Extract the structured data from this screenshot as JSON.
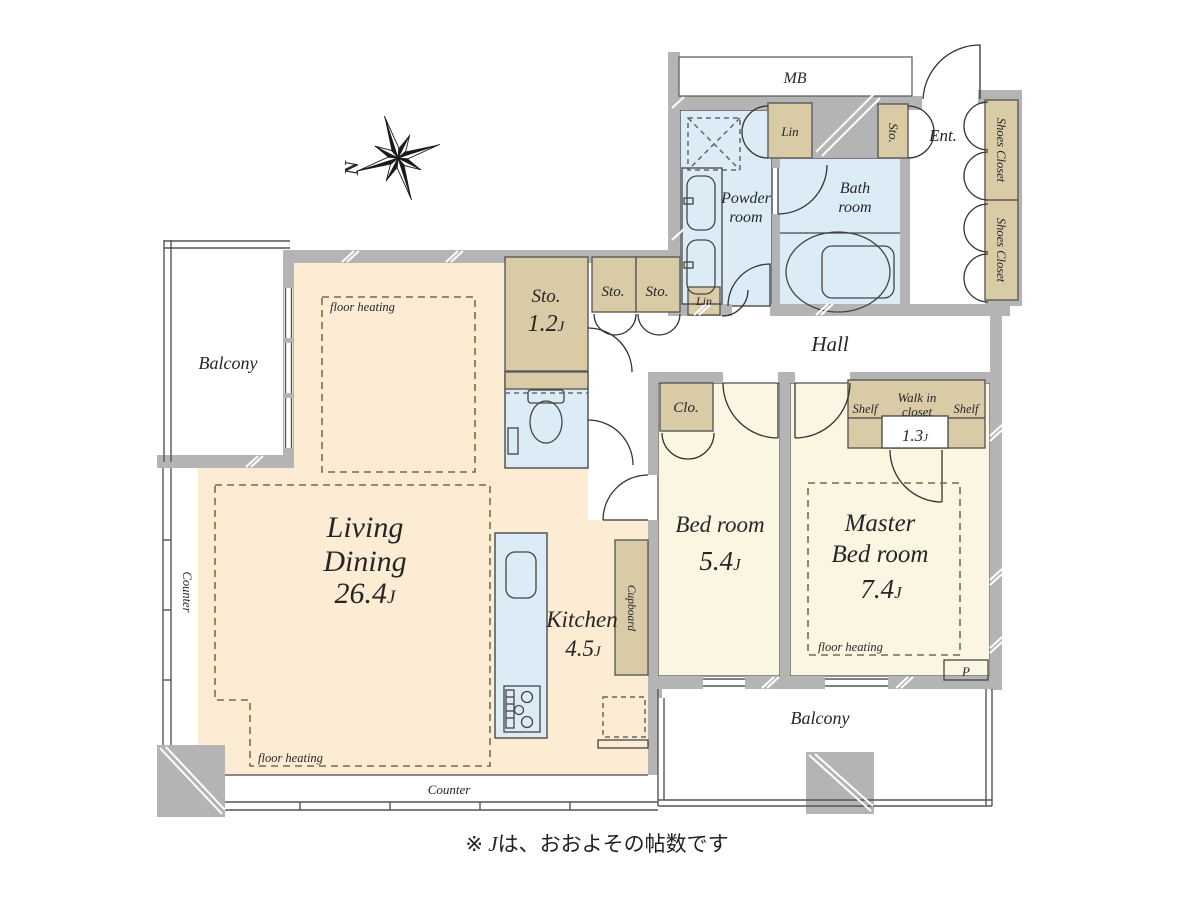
{
  "colors": {
    "living_floor": "#fcecd3",
    "bedroom_floor": "#faf6e2",
    "wet_area_floor": "#dcecf7",
    "closet_fill": "#d8cba6",
    "wall_gray": "#b4b4b4",
    "line": "#444444"
  },
  "compass": {
    "north": "N"
  },
  "labels": {
    "mb": "MB",
    "powder_room_line1": "Powder",
    "powder_room_line2": "room",
    "bath_room_line1": "Bath",
    "bath_room_line2": "room",
    "lin_upper": "Lin",
    "lin_lower": "Lin",
    "sto_entrance": "Sto.",
    "ent": "Ent.",
    "shoes_closet_upper": "Shoes Closet",
    "shoes_closet_lower": "Shoes Closet",
    "hall": "Hall",
    "sto_large_name": "Sto.",
    "sto_large_size": "1.2",
    "sto_large_unit": "J",
    "sto_small_1": "Sto.",
    "sto_small_2": "Sto.",
    "clo": "Clo.",
    "balcony_left": "Balcony",
    "balcony_bottom": "Balcony",
    "counter_left": "Counter",
    "counter_bottom": "Counter",
    "living_line1": "Living",
    "living_line2": "Dining",
    "living_size": "26.4",
    "living_unit": "J",
    "kitchen_name": "Kitchen",
    "kitchen_size": "4.5",
    "kitchen_unit": "J",
    "cupboard": "Cupboard",
    "bedroom_name": "Bed room",
    "bedroom_size": "5.4",
    "bedroom_unit": "J",
    "master_line1": "Master",
    "master_line2": "Bed room",
    "master_size": "7.4",
    "master_unit": "J",
    "wic_line1": "Walk in",
    "wic_line2": "closet",
    "wic_size": "1.3",
    "wic_unit": "J",
    "shelf_left": "Shelf",
    "shelf_right": "Shelf",
    "fh_living_upper": "floor heating",
    "fh_living_lower": "floor heating",
    "fh_master": "floor heating",
    "p": "P"
  },
  "footnote": {
    "symbol": "※ ",
    "j": "J",
    "text": "は、おおよその帖数です"
  }
}
